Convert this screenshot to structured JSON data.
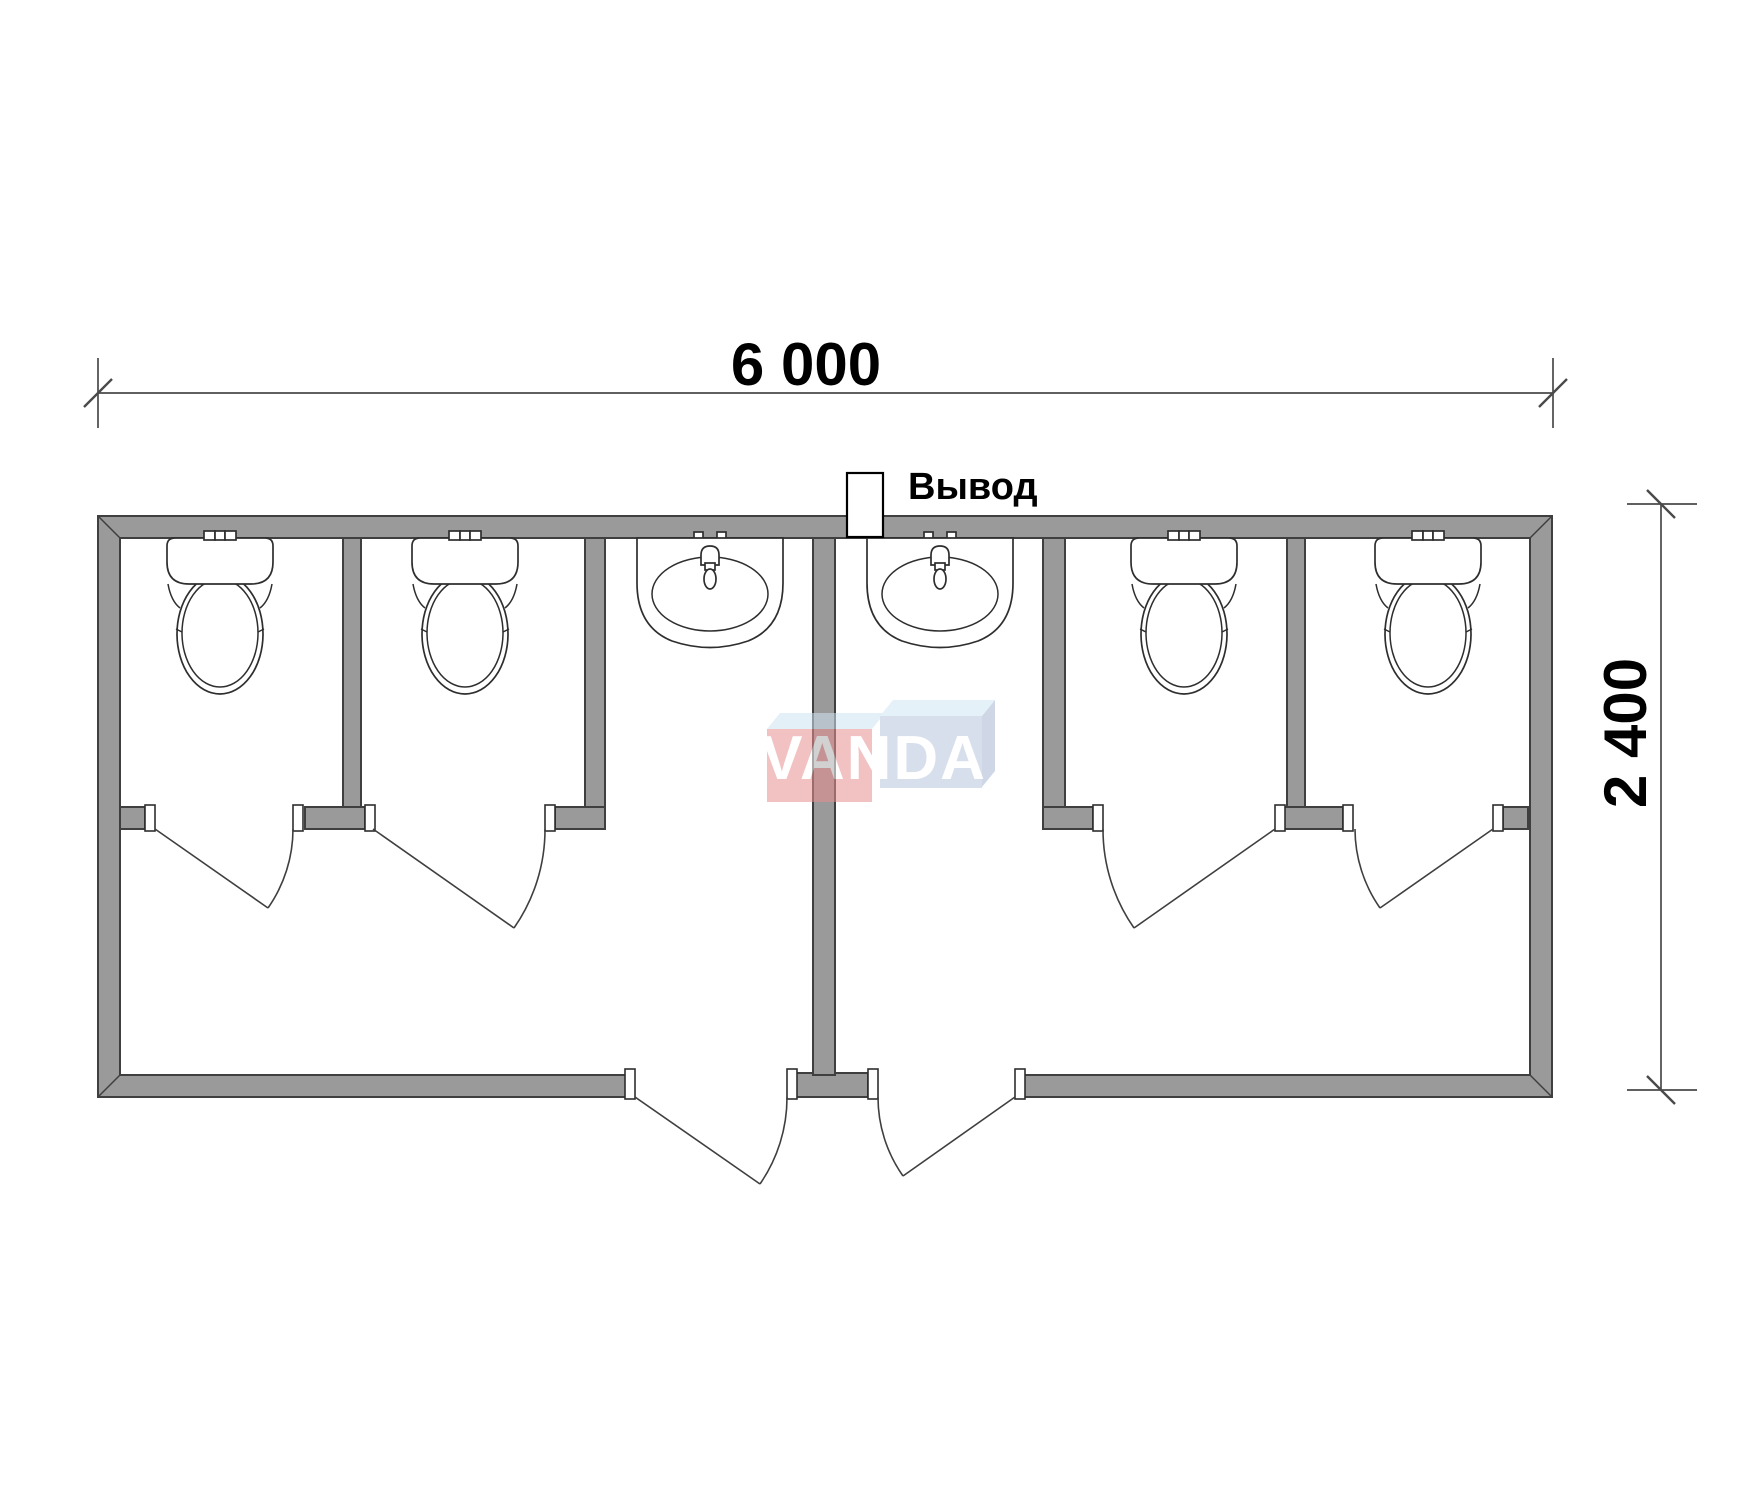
{
  "page": {
    "background": "#ffffff"
  },
  "dimensions": {
    "width_label": "6 000",
    "height_label": "2 400",
    "width_mm": 6000,
    "height_mm": 2400
  },
  "labels": {
    "outlet": "Вывод"
  },
  "watermark": {
    "text": "VANDA"
  },
  "fixtures": {
    "toilets": 4,
    "sinks": 2,
    "toilet_stall_doors": 4,
    "entrance_doors": 2
  },
  "colors": {
    "wall_fill": "#9a9a9a",
    "wall_outline": "#3f3f3f",
    "dimension_line": "#4a4a4a",
    "text": "#000000",
    "watermark_red": "#e98f8f",
    "watermark_blue": "#b9c6dd",
    "watermark_bevel_blue": "#cfe4f2",
    "watermark_bevel_blue2": "#cfe6f5",
    "watermark_side_blue": "#a8b8d2",
    "watermark_text": "#ffffff"
  }
}
